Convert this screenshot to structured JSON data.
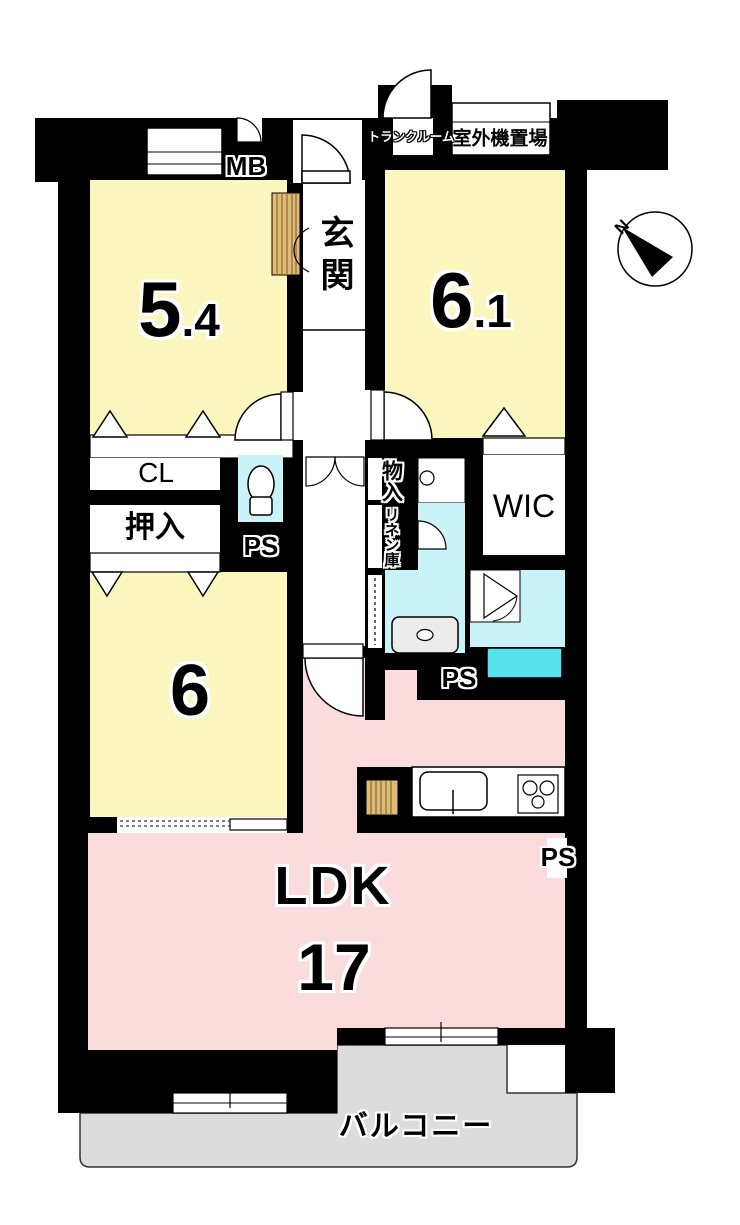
{
  "plan": {
    "north_label": "N",
    "labels": {
      "meter_box": "MB",
      "trunk_room": "トランクルーム",
      "outdoor_unit": "室外機置場",
      "entrance": "玄関",
      "closet": "CL",
      "oshiire": "押入",
      "pipe_space": "PS",
      "storage": "物入",
      "linen": "リネン庫",
      "walk_in_closet": "WIC",
      "balcony": "バルコニー"
    },
    "rooms": {
      "bedroom_nw": {
        "label": "5.4",
        "main": "5",
        "frac": ".4"
      },
      "bedroom_ne": {
        "label": "6.1",
        "main": "6",
        "frac": ".1"
      },
      "bedroom_sw": {
        "label": "6",
        "main": "6"
      },
      "ldk": {
        "name": "LDK",
        "size": "17"
      }
    },
    "colors": {
      "wall_black": "#000000",
      "room_yellow": "#FAF6BE",
      "ldk_pink": "#FADCDC",
      "water_cyan": "#C9F3F8",
      "tub_cyan": "#59E3EF",
      "balcony_gray": "#DCDCDC",
      "cabinet_tan": "#DFBC75"
    }
  }
}
